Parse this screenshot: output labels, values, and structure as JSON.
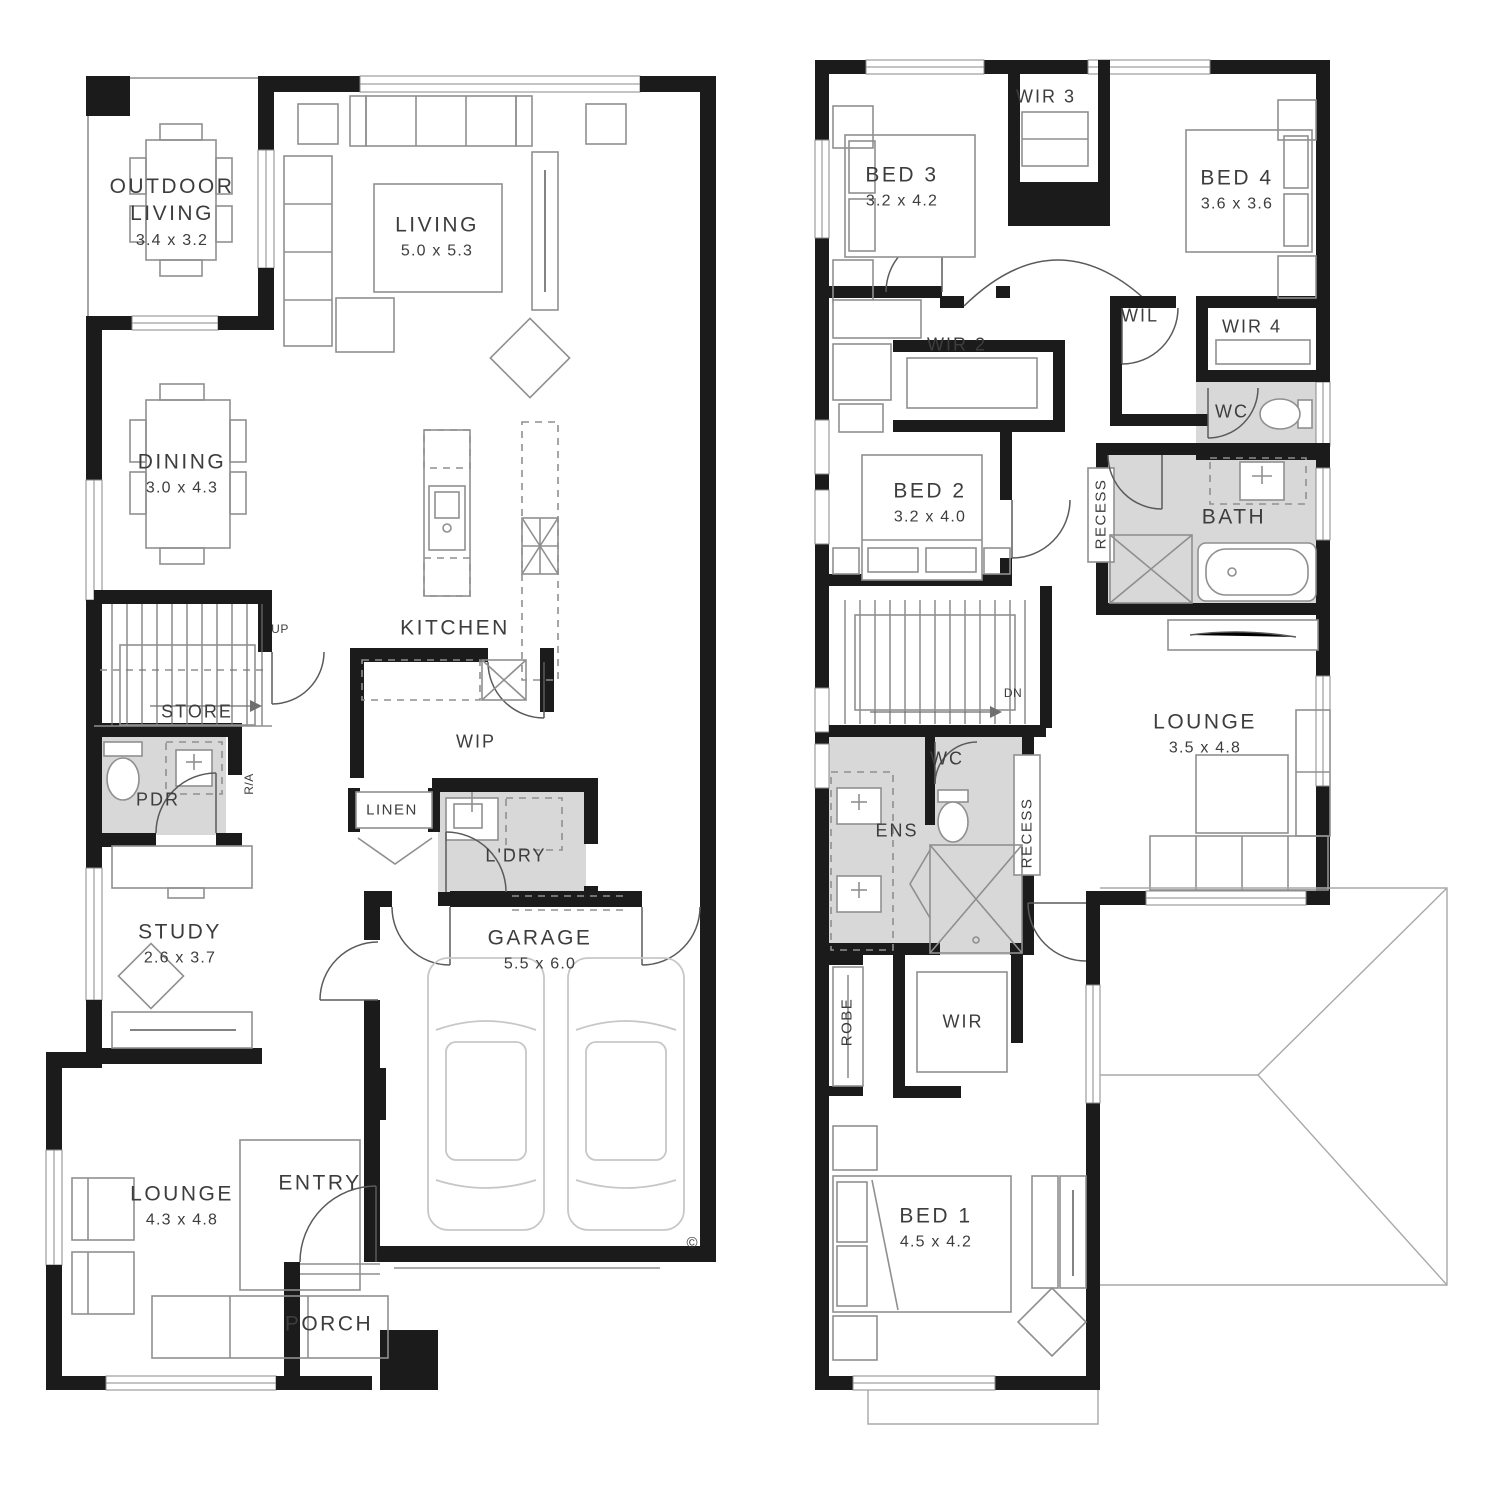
{
  "title": "Double storey home floor plan",
  "colors": {
    "wall": "#1b1b1b",
    "wet_area_fill": "#d8d8d8",
    "furniture_line": "#8f8f8f",
    "label_text": "#3d3d3d",
    "background": "#ffffff"
  },
  "symbols": {
    "copyright": "©"
  },
  "floors": {
    "ground": {
      "name": "Ground Floor",
      "rooms": {
        "outdoor_living": {
          "name": "OUTDOOR LIVING",
          "dims": "3.4 x 3.2"
        },
        "living": {
          "name": "LIVING",
          "dims": "5.0 x 5.3"
        },
        "dining": {
          "name": "DINING",
          "dims": "3.0 x 4.3"
        },
        "kitchen": {
          "name": "KITCHEN"
        },
        "wip": {
          "name": "WIP"
        },
        "store": {
          "name": "STORE"
        },
        "pdr": {
          "name": "PDR"
        },
        "ra": {
          "name": "R/A"
        },
        "up": {
          "name": "UP"
        },
        "linen": {
          "name": "LINEN"
        },
        "ldry": {
          "name": "L'DRY"
        },
        "study": {
          "name": "STUDY",
          "dims": "2.6 x 3.7"
        },
        "garage": {
          "name": "GARAGE",
          "dims": "5.5 x 6.0"
        },
        "entry": {
          "name": "ENTRY"
        },
        "lounge": {
          "name": "LOUNGE",
          "dims": "4.3 x 4.8"
        },
        "porch": {
          "name": "PORCH"
        }
      }
    },
    "first": {
      "name": "First Floor",
      "rooms": {
        "wir3": {
          "name": "WIR 3"
        },
        "bed3": {
          "name": "BED 3",
          "dims": "3.2 x 4.2"
        },
        "bed4": {
          "name": "BED 4",
          "dims": "3.6 x 3.6"
        },
        "wir2": {
          "name": "WIR 2"
        },
        "wil": {
          "name": "WIL"
        },
        "wir4": {
          "name": "WIR 4"
        },
        "wc_upper": {
          "name": "WC"
        },
        "bed2": {
          "name": "BED 2",
          "dims": "3.2 x 4.0"
        },
        "recess_bath": {
          "name": "RECESS"
        },
        "bath": {
          "name": "BATH"
        },
        "dn": {
          "name": "DN"
        },
        "lounge": {
          "name": "LOUNGE",
          "dims": "3.5 x 4.8"
        },
        "wc_mid": {
          "name": "WC"
        },
        "ens": {
          "name": "ENS"
        },
        "recess_ens": {
          "name": "RECESS"
        },
        "robe": {
          "name": "ROBE"
        },
        "wir": {
          "name": "WIR"
        },
        "bed1": {
          "name": "BED 1",
          "dims": "4.5 x 4.2"
        }
      }
    }
  }
}
